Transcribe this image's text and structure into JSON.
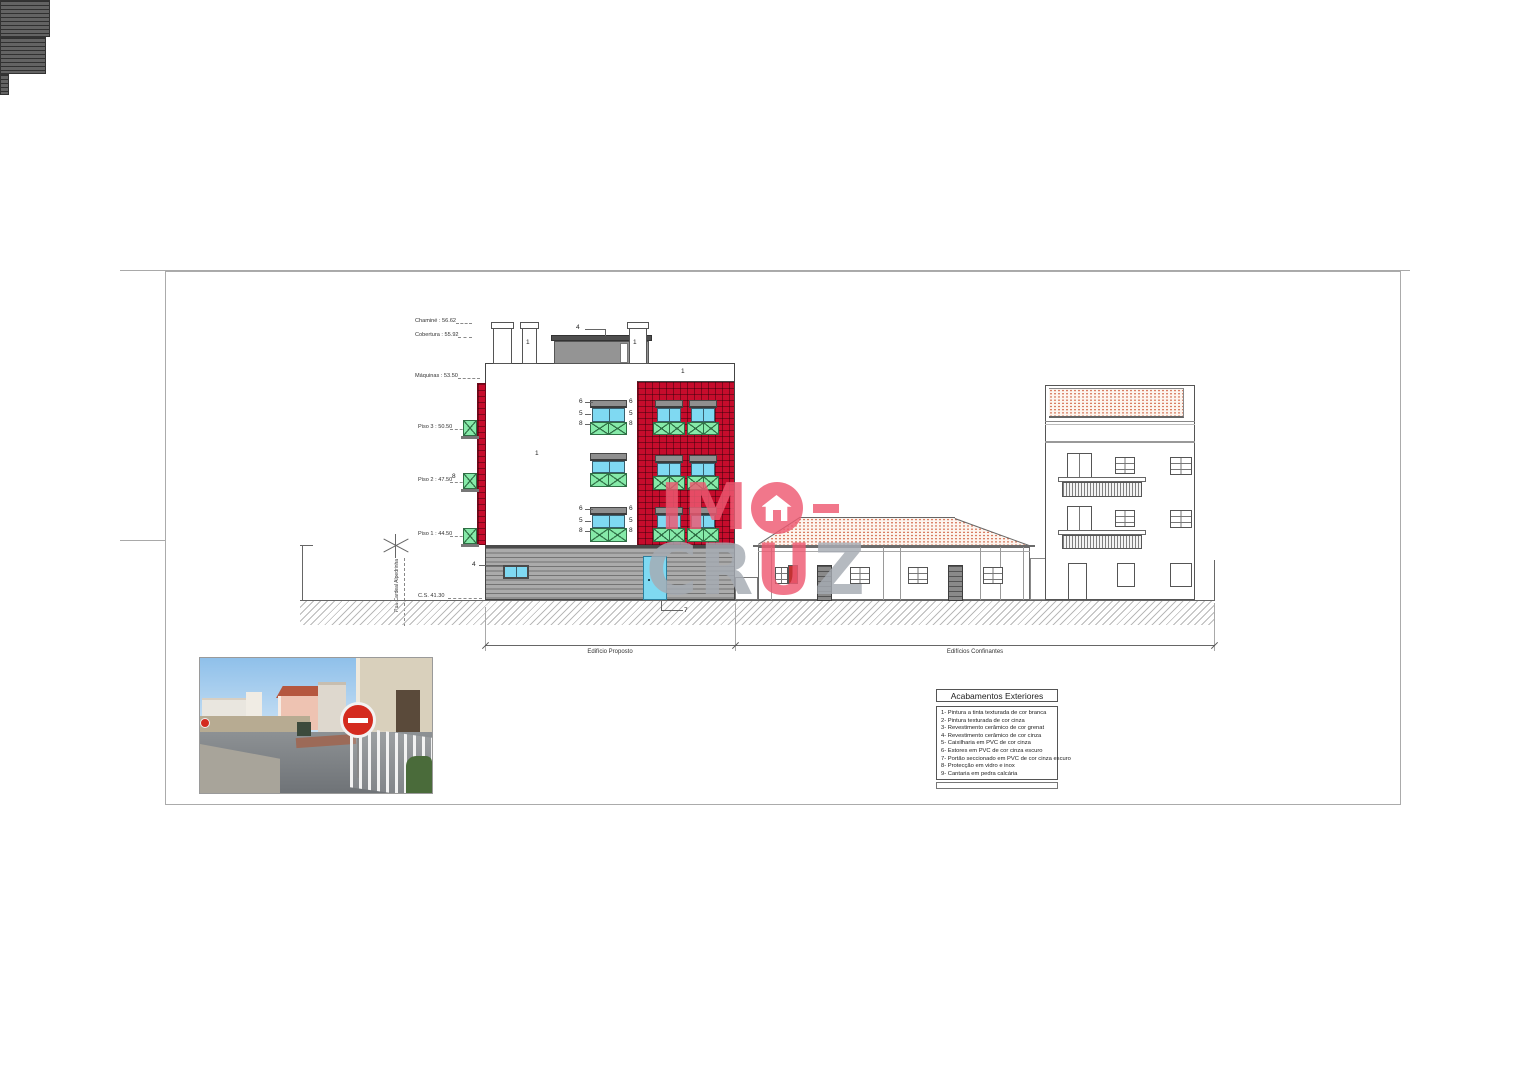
{
  "levels": [
    {
      "text": "Chaminé : 56.62"
    },
    {
      "text": "Cobertura : 55.92"
    },
    {
      "text": "Máquinas : 53.50"
    },
    {
      "text": "Piso 3 : 50.50"
    },
    {
      "text": "Piso 2 : 47.50"
    },
    {
      "text": "Piso 1 : 44.50"
    },
    {
      "text": "C.S. 41.30"
    }
  ],
  "street": {
    "name": "Rua Cardeal Alpedrinha"
  },
  "dimensions": {
    "left": "Edifício Proposto",
    "right": "Edifícios Confinantes"
  },
  "callouts": {
    "one": "1",
    "four": "4",
    "five": "5",
    "six": "6",
    "seven": "7",
    "eight": "8"
  },
  "legend": {
    "title": "Acabamentos Exteriores",
    "items": [
      "1- Pintura a tinta texturada de cor branca",
      "2- Pintura texturada de cor cinza",
      "3- Revestimento cerâmico de cor grenat",
      "4- Revestimento cerâmico de cor cinza",
      "5- Caixilharia em PVC de cor cinza",
      "6- Estores em PVC de cor cinza escuro",
      "7- Portão seccionado em PVC de cor cinza escuro",
      "8- Protecção em vidro e inox",
      "9- Cantaria em pedra calcária"
    ]
  },
  "watermark": {
    "i": "I",
    "m": "M",
    "c": "C",
    "r": "R",
    "u": "U",
    "z": "Z"
  },
  "colors": {
    "tile_red": "#c60c2c",
    "glass_cyan": "#7fd9f2",
    "railing_green": "#86eaa9",
    "logo_pink": "#ee5a72",
    "logo_gray": "#a6abb3",
    "roof_tile_orange": "#d06040",
    "sign_red": "#d42b1f"
  }
}
